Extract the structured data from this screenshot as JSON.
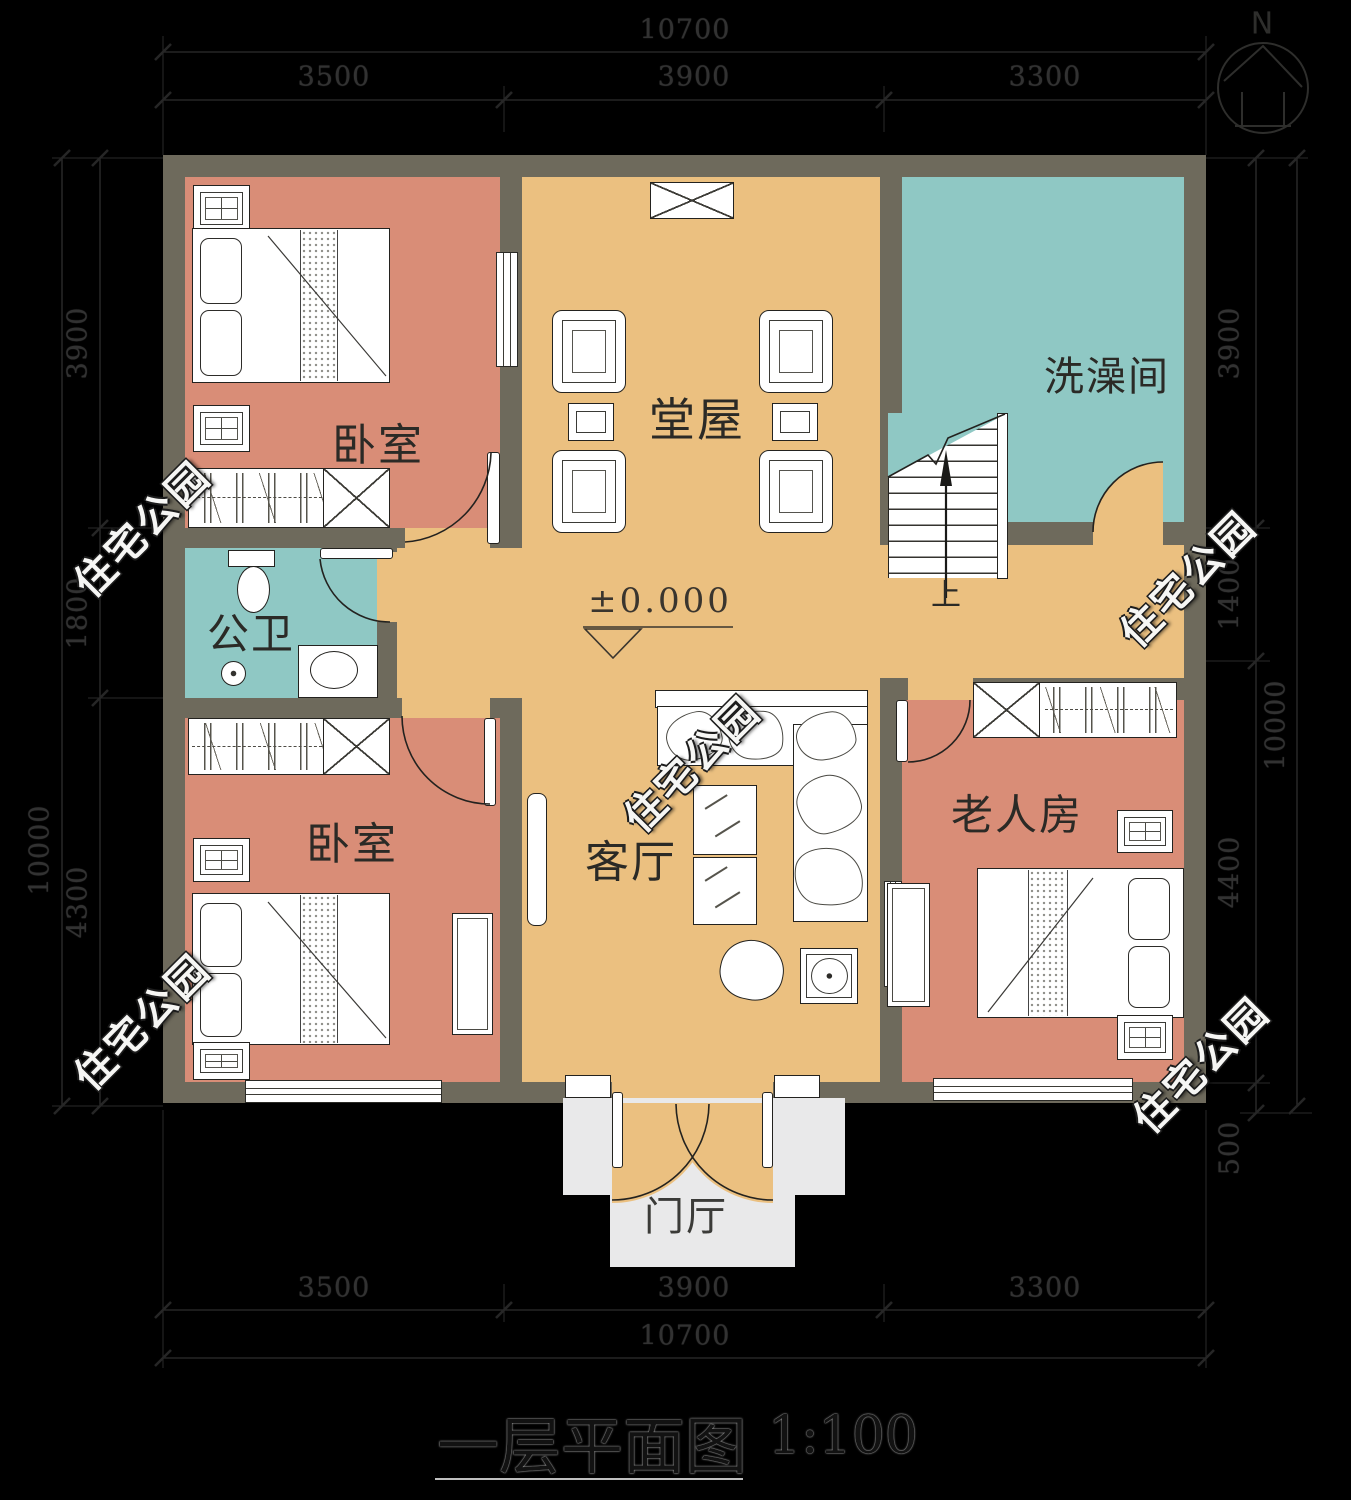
{
  "title": {
    "text": "一层平面图",
    "scale": "1:100"
  },
  "north": {
    "label": "N"
  },
  "level_marker": {
    "value": "±0.000"
  },
  "stairs": {
    "direction_label": "上"
  },
  "watermark": {
    "text": "住宅公园"
  },
  "rooms": {
    "bedroom_top": {
      "label": "卧室"
    },
    "hall": {
      "label": "堂屋"
    },
    "shower": {
      "label": "洗澡间"
    },
    "toilet": {
      "label": "公卫"
    },
    "bedroom_bottom": {
      "label": "卧室"
    },
    "living": {
      "label": "客厅"
    },
    "elder": {
      "label": "老人房"
    },
    "foyer": {
      "label": "门厅"
    }
  },
  "dimensions": {
    "top": {
      "overall": "10700",
      "segments": [
        "3500",
        "3900",
        "3300"
      ]
    },
    "bottom": {
      "overall": "10700",
      "segments": [
        "3500",
        "3900",
        "3300"
      ]
    },
    "left": {
      "overall": "10000",
      "segments": [
        "3900",
        "1800",
        "4300"
      ]
    },
    "right": {
      "overall": "10000",
      "segments": [
        "3900",
        "1400",
        "4400",
        "500"
      ]
    }
  },
  "colors": {
    "background": "#000000",
    "wall": "#6e6a5c",
    "bedroom_floor": "#d98d77",
    "hall_floor": "#ebc080",
    "wet_room_floor": "#8fc8c4",
    "porch_floor": "#e9e9ea"
  }
}
